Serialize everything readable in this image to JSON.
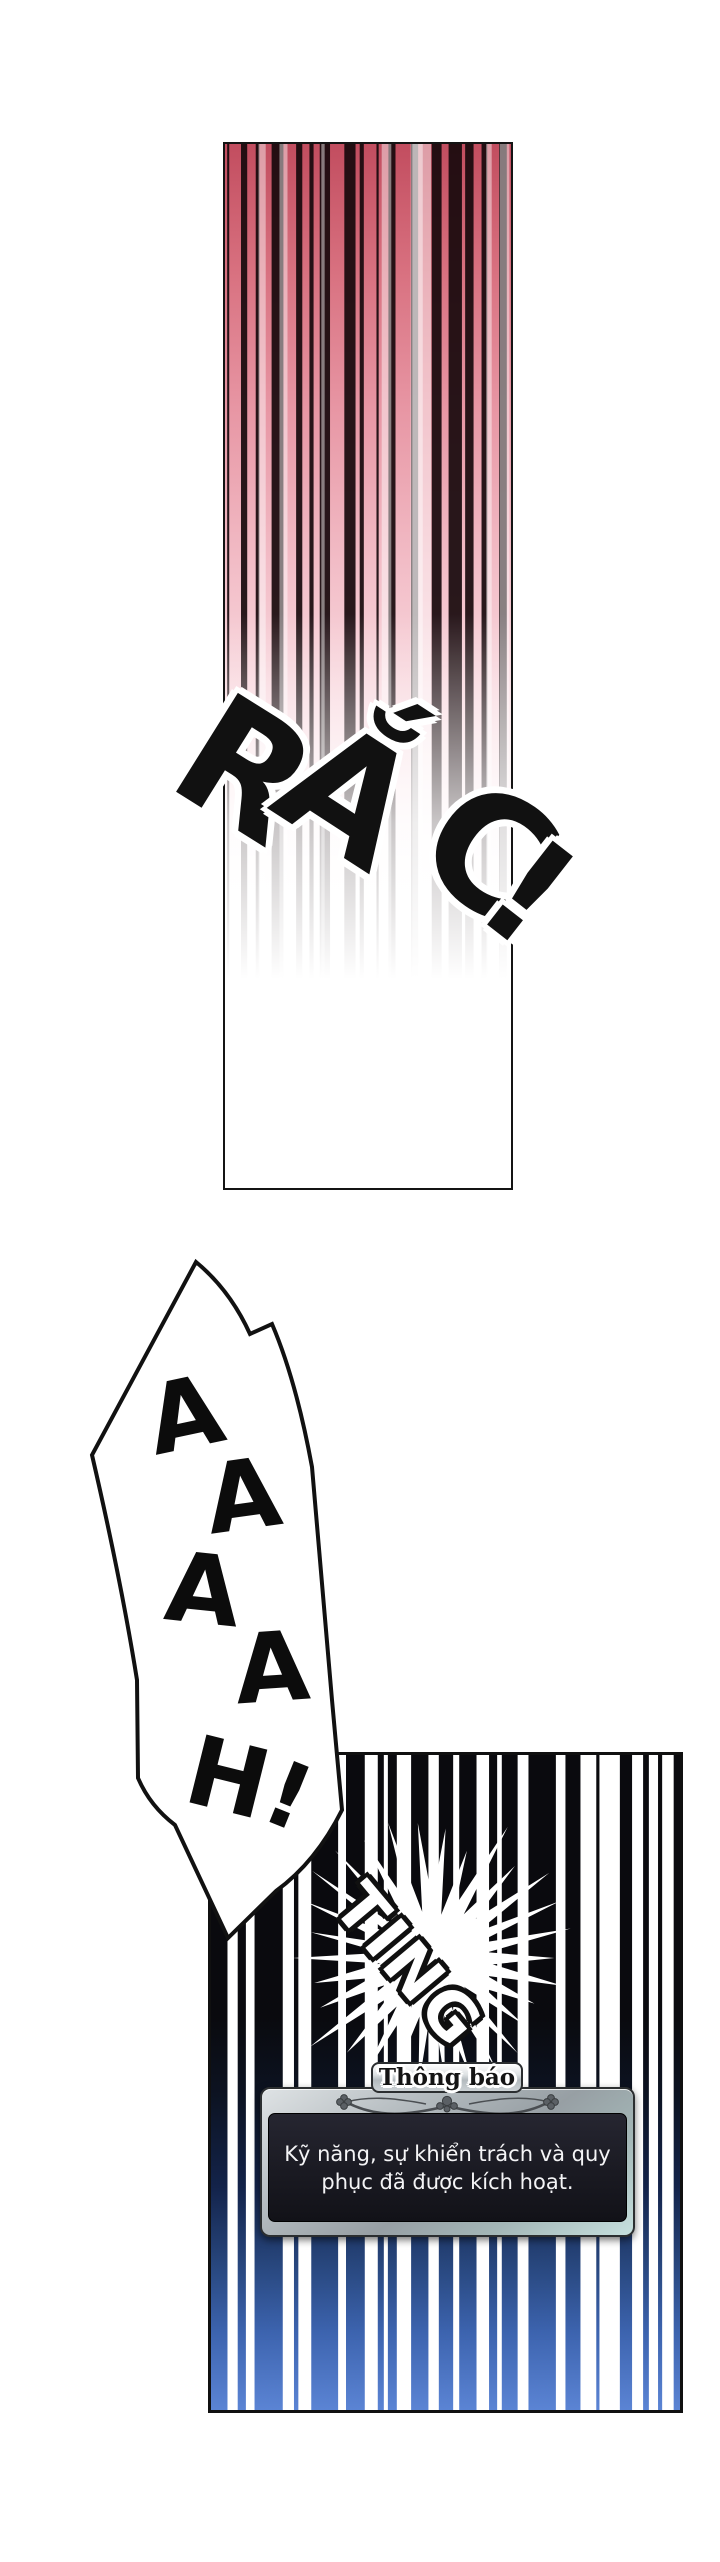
{
  "page": {
    "background": "#ffffff"
  },
  "panel_top": {
    "sfx": "RẮC!",
    "stripe_color": "#17090c",
    "gradient_top_color": "#c24d5f",
    "gradient_mid_color": "#f2bcc6",
    "gradient_bottom_color": "#ffffff"
  },
  "scream_bubble": {
    "text": "AAAAH!"
  },
  "panel_bottom": {
    "sfx": "TING",
    "stripe_top_color": "#0a0a0e",
    "stripe_mid_color": "#13234a",
    "stripe_bottom_color": "#5b84d4",
    "gap_color": "#ffffff"
  },
  "notification": {
    "title": "Thông báo",
    "lines": [
      "Kỹ năng, sự khiển trách và quy",
      "phục đã được kích hoạt."
    ],
    "frame_color": "#a7aeb3",
    "panel_color": "#1b1b22",
    "text_color": "#f4f4f6"
  }
}
